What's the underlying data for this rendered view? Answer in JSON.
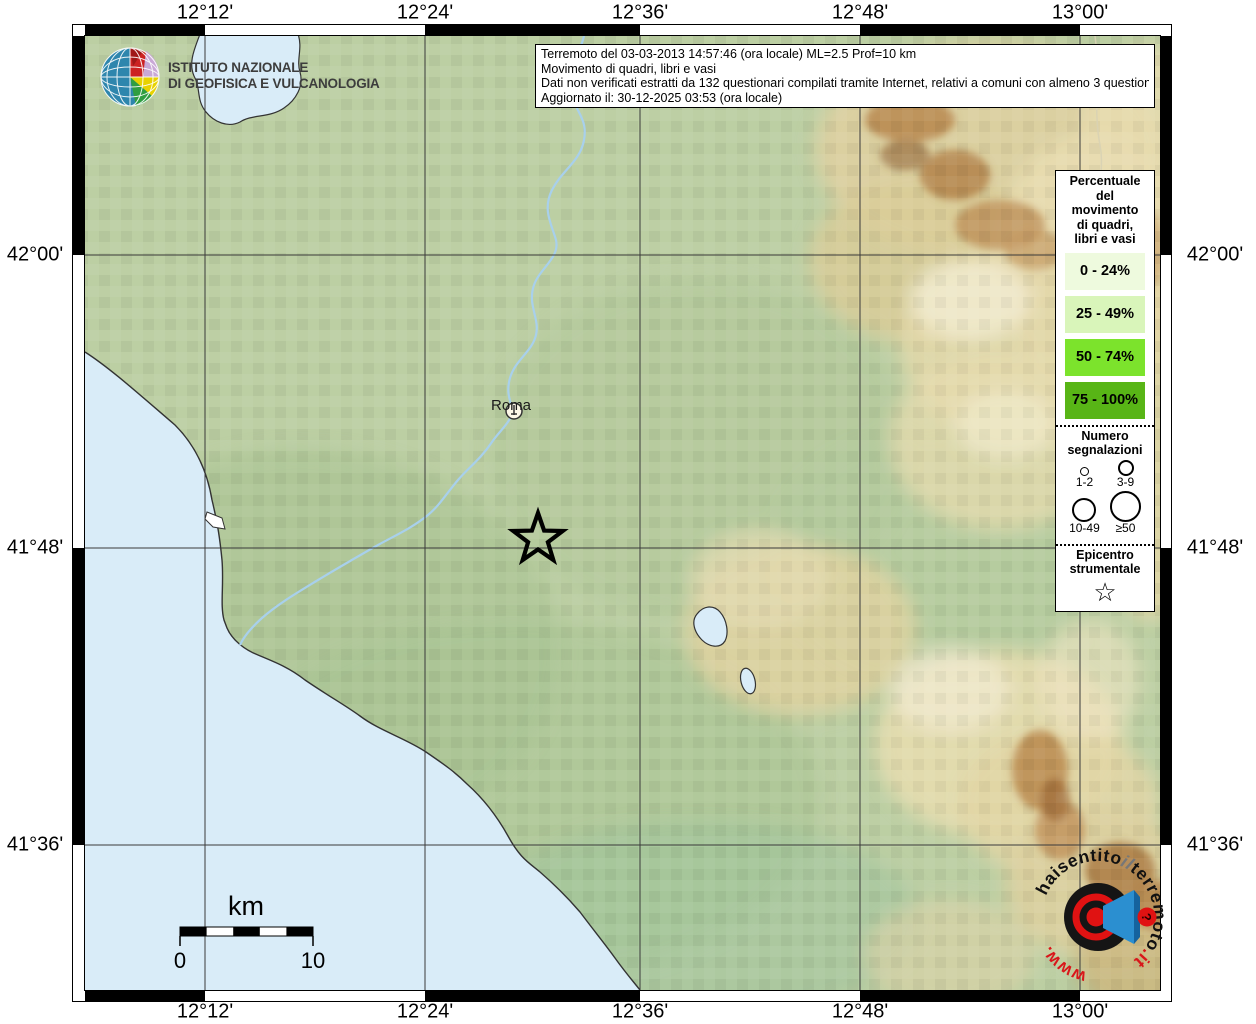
{
  "ingv": {
    "name_line1": "ISTITUTO NAZIONALE",
    "name_line2": "DI GEOFISICA E VULCANOLOGIA"
  },
  "info_box": {
    "line1": "Terremoto del 03-03-2013 14:57:46 (ora locale) ML=2.5 Prof=10 km",
    "line2": "Movimento di quadri, libri e vasi",
    "line3": "Dati non verificati estratti da 132 questionari compilati tramite Internet, relativi a comuni con almeno 3 questionari.",
    "line4": "Aggiornato il: 30-12-2025 03:53 (ora locale)"
  },
  "axes": {
    "top": [
      "12°12'",
      "12°24'",
      "12°36'",
      "12°48'",
      "13°00'"
    ],
    "bottom": [
      "12°12'",
      "12°24'",
      "12°36'",
      "12°48'",
      "13°00'"
    ],
    "left": [
      "42°00'",
      "41°48'",
      "41°36'"
    ],
    "right": [
      "42°00'",
      "41°48'",
      "41°36'"
    ]
  },
  "legend": {
    "percent_title": "Percentuale\ndel\nmovimento\ndi quadri,\nlibri e vasi",
    "classes": [
      {
        "label": "0 - 24%",
        "color": "#eefade"
      },
      {
        "label": "25 - 49%",
        "color": "#d9f5ba"
      },
      {
        "label": "50 - 74%",
        "color": "#7ce32c"
      },
      {
        "label": "75 - 100%",
        "color": "#58b516"
      }
    ],
    "numero_title": "Numero\nsegnalazioni",
    "size_labels": [
      "1-2",
      "3-9",
      "10-49",
      "≥50"
    ],
    "epicentro_title": "Epicentro\nstrumentale",
    "epicentro_star": "☆"
  },
  "map": {
    "city": "Roma",
    "scalebar": {
      "unit": "km",
      "start": "0",
      "end": "10"
    }
  },
  "logo": {
    "arc_pre": "haisentito",
    "arc_mid": "il",
    "arc_main": "terremoto",
    "arc_tld": ".it",
    "arc_www": "www.",
    "question": "?"
  }
}
